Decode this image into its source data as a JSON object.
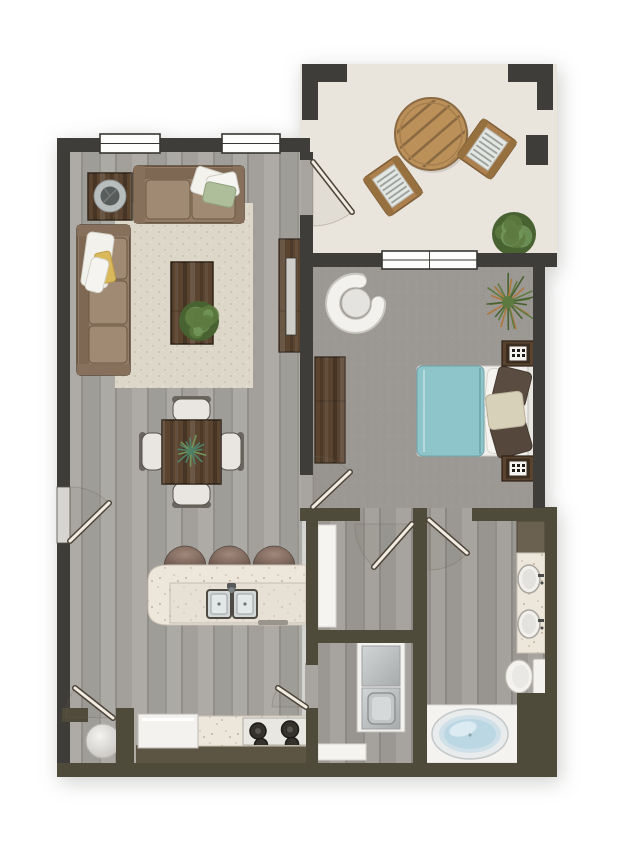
{
  "app": {
    "type": "floor-plan-rendering",
    "description": "Top-down furnished color rendering of a one-bedroom, one-bath apartment floor plan with private patio",
    "visible_text": []
  },
  "colors": {
    "wall": "#3e3d39",
    "wall2": "#4f4b3b",
    "patio_floor": "#e9e4dc",
    "wood_floor": "#a8a5a0",
    "wood_floor2": "#a09d98",
    "carpet": "#9c9894",
    "rug": "#dcd7c9",
    "counter": "#ece6db",
    "duvet": "#8ec5ca",
    "tub_water": "#bad7e3",
    "sofa": "#937c67",
    "sofa_cushion": "#a18a74",
    "wood_dark": "#5a4430",
    "white_goods": "#f3f2ef",
    "window": "#fdfdfc",
    "accent_throw": "#d9b95c",
    "pillow_green": "#aebd9a",
    "pillow_dark": "#5a4c41",
    "pillow_cream": "#d8d1ba",
    "patio_wood": "#bb9059",
    "chair_cushion": "#e4e6e2",
    "stool_top": "#a3887c",
    "stool_edge": "#6d594f",
    "plant_leaf_dark": "#486331",
    "plant_leaf": "#5d7a40",
    "plant_leaf_light": "#72955a",
    "plant_orange": "#b0793f",
    "plant_teal": "#4f8066",
    "linen_cabinet": "#6b6150"
  },
  "rooms": {
    "patio": {
      "label": "Patio",
      "items": [
        "round-slatted-table",
        "two-armchairs",
        "shrub"
      ]
    },
    "living_room": {
      "label": "Living Room",
      "items": [
        "three-seat-sofa",
        "loveseat",
        "coffee-table",
        "end-table-with-bowl",
        "area-rug",
        "tv-console"
      ]
    },
    "dining_area": {
      "label": "Dining Area",
      "items": [
        "square-table",
        "four-chairs",
        "centerpiece-plant"
      ]
    },
    "kitchen": {
      "label": "Kitchen",
      "items": [
        "island-with-double-sink",
        "three-bar-stools",
        "cooktop",
        "refrigerator",
        "base-cabinet-run",
        "water-heater"
      ]
    },
    "bedroom": {
      "label": "Bedroom",
      "items": [
        "bed-with-teal-duvet",
        "two-nightstands",
        "dresser",
        "accent-chair",
        "floor-plant"
      ]
    },
    "closet": {
      "label": "Walk-in Closet",
      "items": [
        "shelving"
      ]
    },
    "laundry": {
      "label": "Laundry",
      "items": [
        "stacked-washer-dryer",
        "shelf"
      ]
    },
    "bathroom": {
      "label": "Bathroom",
      "items": [
        "double-sink-vanity",
        "linen-cabinet",
        "toilet",
        "oval-soaking-tub"
      ]
    }
  },
  "counts": {
    "windows": 3,
    "doors": 7,
    "bar_stools": 3,
    "dining_chairs": 4,
    "patio_chairs": 2
  }
}
